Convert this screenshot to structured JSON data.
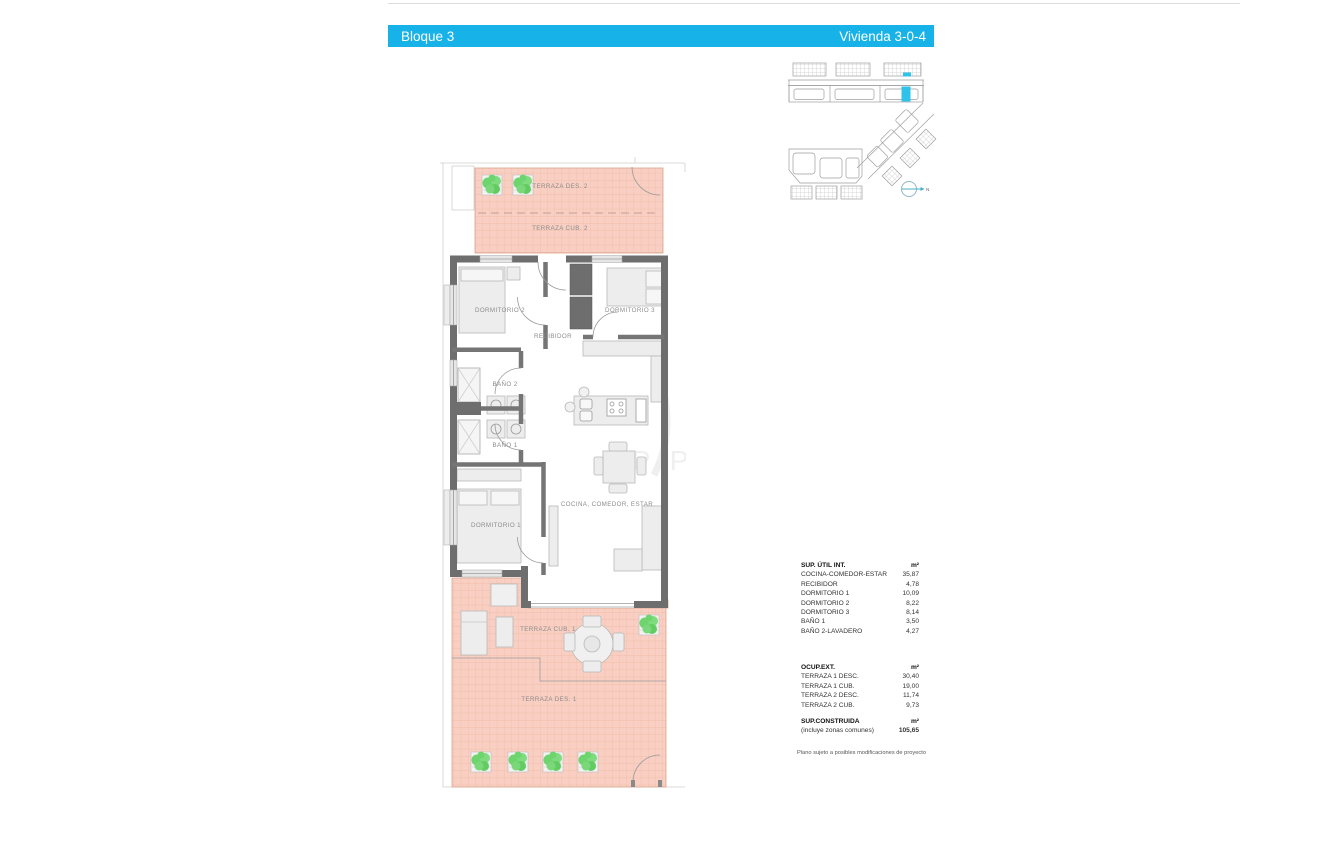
{
  "header": {
    "block_label": "Bloque 3",
    "unit_label": "Vivienda 3-0-4"
  },
  "colors": {
    "accent": "#16b2e8",
    "terrace_fill": "#f8cfc2",
    "terrace_grid": "#efb7a2",
    "wall": "#6e6e6e",
    "furniture_fill": "#ededed",
    "plant_green": "#6ed46e"
  },
  "floor_plan": {
    "labels": {
      "terraza_des_2": "TERRAZA DES. 2",
      "terraza_cub_2": "TERRAZA CUB. 2",
      "dormitorio_2": "DORMITORIO 2",
      "dormitorio_3": "DORMITORIO 3",
      "recibidor": "RECIBIDOR",
      "bano_2": "BAÑO 2",
      "bano_1": "BAÑO 1",
      "dormitorio_1": "DORMITORIO 1",
      "cocina_comedor_estar": "COCINA, COMEDOR, ESTAR",
      "terraza_cub_1": "TERRAZA CUB. 1",
      "terraza_des_1": "TERRAZA DES. 1"
    },
    "watermark": "J P P"
  },
  "site_plan": {
    "north_label": "N"
  },
  "tables": {
    "util": {
      "title": "SUP. ÚTIL INT.",
      "unit": "m²",
      "rows": [
        {
          "label": "COCINA-COMEDOR-ESTAR",
          "value": "35,87"
        },
        {
          "label": "RECIBIDOR",
          "value": "4,78"
        },
        {
          "label": "DORMITORIO 1",
          "value": "10,09"
        },
        {
          "label": "DORMITORIO 2",
          "value": "8,22"
        },
        {
          "label": "DORMITORIO 3",
          "value": "8,14"
        },
        {
          "label": "BAÑO 1",
          "value": "3,50"
        },
        {
          "label": "BAÑO 2-LAVADERO",
          "value": "4,27"
        }
      ]
    },
    "ext": {
      "title": "OCUP.EXT.",
      "unit": "m²",
      "rows": [
        {
          "label": "TERRAZA 1 DESC.",
          "value": "30,40"
        },
        {
          "label": "TERRAZA 1 CUB.",
          "value": "19,00"
        },
        {
          "label": "TERRAZA 2 DESC.",
          "value": "11,74"
        },
        {
          "label": "TERRAZA 2 CUB.",
          "value": "9,73"
        }
      ]
    },
    "built": {
      "title": "SUP.CONSTRUIDA",
      "unit": "m²",
      "subtitle": "(incluye zonas comunes)",
      "value": "105,65"
    }
  },
  "note": "Plano sujeto a posibles modificaciones de proyecto"
}
